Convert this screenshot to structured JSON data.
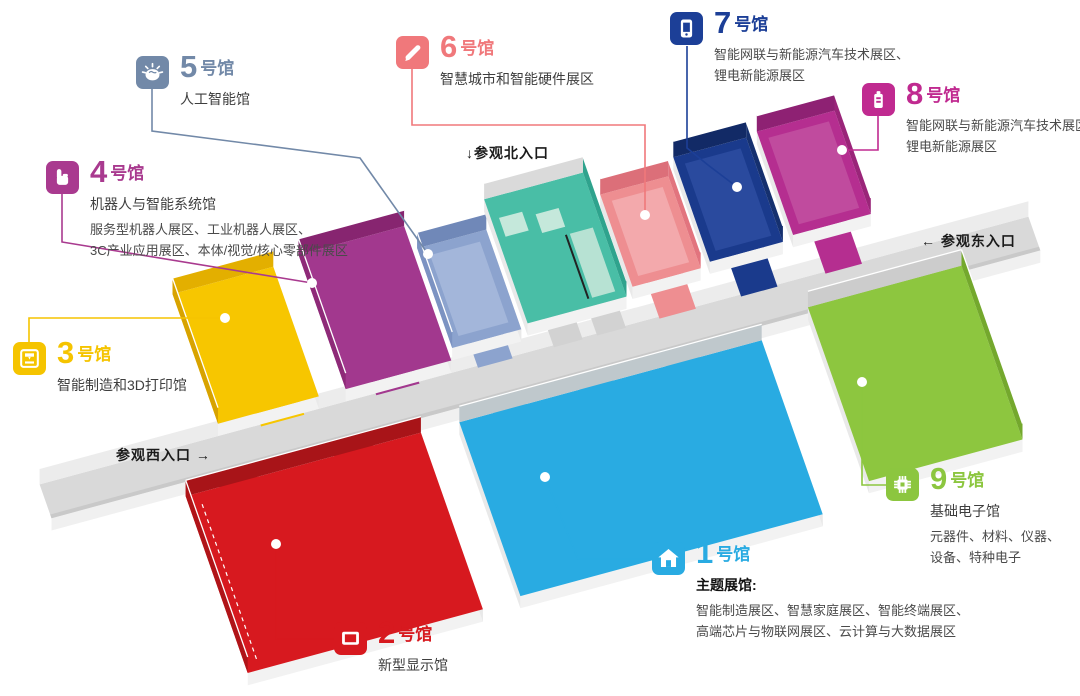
{
  "halls": [
    {
      "num": "1",
      "suffix": "号馆",
      "color": "#29ABE2",
      "subtitle": "主题展馆:",
      "subtitle_bold": true,
      "desc": [
        "智能制造展区、智慧家庭展区、智能终端展区、",
        "高端芯片与物联网展区、云计算与大数据展区"
      ],
      "icon": "house-icon"
    },
    {
      "num": "2",
      "suffix": "号馆",
      "color": "#D7191F",
      "subtitle": "新型显示馆",
      "desc": [],
      "icon": "display-icon"
    },
    {
      "num": "3",
      "suffix": "号馆",
      "color": "#F5C400",
      "subtitle": "智能制造和3D打印馆",
      "desc": [],
      "icon": "printer-3d-icon"
    },
    {
      "num": "4",
      "suffix": "号馆",
      "color": "#A93A8F",
      "subtitle": "机器人与智能系统馆",
      "desc": [
        "服务型机器人展区、工业机器人展区、",
        "3C产业应用展区、本体/视觉/核心零部件展区"
      ],
      "icon": "hand-icon"
    },
    {
      "num": "5",
      "suffix": "号馆",
      "color": "#7289A8",
      "subtitle": "人工智能馆",
      "desc": [],
      "icon": "brain-icon"
    },
    {
      "num": "6",
      "suffix": "号馆",
      "color": "#F0787B",
      "subtitle": "智慧城市和智能硬件展区",
      "desc": [],
      "icon": "pen-icon"
    },
    {
      "num": "7",
      "suffix": "号馆",
      "color": "#1C3F97",
      "subtitle": "",
      "desc": [
        "智能网联与新能源汽车技术展区、",
        "锂电新能源展区"
      ],
      "icon": "smart-device-icon"
    },
    {
      "num": "8",
      "suffix": "号馆",
      "color": "#C02A90",
      "subtitle": "",
      "desc": [
        "智能网联与新能源汽车技术展区",
        "锂电新能源展区"
      ],
      "icon": "battery-icon"
    },
    {
      "num": "9",
      "suffix": "号馆",
      "color": "#8CC63F",
      "subtitle": "基础电子馆",
      "desc": [
        "元器件、材料、仪器、",
        "设备、特种电子"
      ],
      "icon": "chip-icon"
    }
  ],
  "entrances": {
    "north": "↓参观北入口",
    "east": "← 参观东入口",
    "west": "参观西入口 →"
  },
  "floorplan": {
    "matrix": [
      0.96,
      -0.26,
      0.33,
      0.94,
      30,
      487
    ],
    "up": [
      5.34,
      -15.54
    ],
    "dn": [
      -4.08,
      11.9
    ],
    "corridor": {
      "u0": 10,
      "u1": 1040,
      "v0": 0,
      "v1": 36,
      "floor": "#D9D9D9",
      "n_wall": "#ECECEC",
      "s_wall": "#F0F0F0",
      "s_shadow": "#C9C9C9"
    },
    "halls": [
      {
        "name": "hall-3",
        "floor": "#F7C600",
        "u0": 200,
        "u1": 305,
        "vB": -150,
        "vF": -12,
        "inner": [
          [
            "N",
            "#E3AF00"
          ],
          [
            "W",
            "#D8A300"
          ]
        ],
        "outer": [
          "S",
          "E"
        ]
      },
      {
        "name": "hall-4",
        "floor": "#A2388E",
        "u0": 333,
        "u1": 443,
        "vB": -155,
        "vF": -12,
        "inner": [
          [
            "N",
            "#872570"
          ],
          [
            "W",
            "#8E2A78"
          ]
        ],
        "outer": [
          "S",
          "E"
        ]
      },
      {
        "name": "hall-5",
        "floor": "#8CA3CE",
        "u0": 448,
        "u1": 520,
        "vB": -130,
        "vF": -24,
        "inner": [
          [
            "N",
            "#7088B8"
          ],
          [
            "W",
            "#7C93C2"
          ]
        ],
        "outer": [
          "S",
          "E"
        ],
        "inset": {
          "pad": 10,
          "fill": "#A3B6DA"
        }
      },
      {
        "name": "north-entrance-hall",
        "floor": "#49BEA6",
        "u0": 528,
        "u1": 631,
        "vB": -160,
        "vF": -28,
        "inner": [
          [
            "N",
            "#DADADA"
          ],
          [
            "E",
            "#2FA38D"
          ]
        ],
        "outer": [
          "S",
          "W"
        ],
        "extras": [
          {
            "u0": 536,
            "u1": 560,
            "v0": -138,
            "v1": -118,
            "fill": "#C5E8DB"
          },
          {
            "u0": 572,
            "u1": 596,
            "v0": -132,
            "v1": -112,
            "fill": "#C5E8DB"
          },
          {
            "u0": 598,
            "u1": 622,
            "v0": -104,
            "v1": -36,
            "fill": "#B7E2D3"
          },
          {
            "line": [
              [
                594,
                -104
              ],
              [
                594,
                -36
              ]
            ],
            "stroke": "#222222",
            "w": 2
          }
        ]
      },
      {
        "name": "hall-6",
        "floor": "#EE8E91",
        "u0": 640,
        "u1": 711,
        "vB": -134,
        "vF": -36,
        "inner": [
          [
            "N",
            "#DC6F79"
          ],
          [
            "E",
            "#E2747E"
          ]
        ],
        "outer": [
          "S",
          "W"
        ],
        "inset": {
          "pad": 9,
          "fill": "#F3A9AC"
        }
      },
      {
        "name": "hall-7",
        "floor": "#1A3A8C",
        "u0": 722,
        "u1": 798,
        "vB": -151,
        "vF": -40,
        "inner": [
          [
            "N",
            "#122A66"
          ],
          [
            "E",
            "#15306F"
          ]
        ],
        "outer": [
          "S",
          "W"
        ],
        "inset": {
          "pad": 9,
          "fill": "#2A4A9E"
        }
      },
      {
        "name": "hall-8",
        "floor": "#B52E90",
        "u0": 810,
        "u1": 891,
        "vB": -154,
        "vF": -44,
        "inner": [
          [
            "N",
            "#8E2173"
          ],
          [
            "E",
            "#9A2579"
          ]
        ],
        "outer": [
          "S",
          "W"
        ],
        "inset": {
          "pad": 9,
          "fill": "#C04B9E"
        }
      },
      {
        "name": "hall-2",
        "floor": "#D7191F",
        "u0": 145,
        "u1": 390,
        "vB": 50,
        "vF": 238,
        "inner": [
          [
            "N",
            "#A81418"
          ],
          [
            "W",
            "#B01418"
          ]
        ],
        "outer": [
          "S",
          "E"
        ],
        "dash": [
          [
            158,
            62
          ],
          [
            158,
            228
          ]
        ]
      },
      {
        "name": "hall-1",
        "floor": "#29ABE2",
        "u0": 430,
        "u1": 745,
        "vB": 50,
        "vF": 235,
        "inner": [
          [
            "N",
            "#BFC8CC"
          ]
        ],
        "outer": [
          "S",
          "E",
          "W"
        ]
      },
      {
        "name": "hall-9",
        "floor": "#8DC63F",
        "u0": 800,
        "u1": 960,
        "vB": 30,
        "vF": 215,
        "inner": [
          [
            "N",
            "#CCCCCC"
          ],
          [
            "E",
            "#74A82D"
          ]
        ],
        "outer": [
          "S",
          "W"
        ]
      }
    ],
    "stubs": [
      {
        "u0": 240,
        "u1": 285,
        "v0": -14,
        "v1": 2,
        "fill": "#F7C600"
      },
      {
        "u0": 360,
        "u1": 405,
        "v0": -14,
        "v1": 2,
        "fill": "#A2388E"
      },
      {
        "u0": 466,
        "u1": 502,
        "v0": -26,
        "v1": 2,
        "fill": "#8CA3CE"
      },
      {
        "u0": 545,
        "u1": 575,
        "v0": -30,
        "v1": 2,
        "fill": "#D2D2D2"
      },
      {
        "u0": 590,
        "u1": 620,
        "v0": -30,
        "v1": 2,
        "fill": "#D2D2D2"
      },
      {
        "u0": 655,
        "u1": 693,
        "v0": -38,
        "v1": 2,
        "fill": "#EE8E91"
      },
      {
        "u0": 740,
        "u1": 778,
        "v0": -42,
        "v1": 2,
        "fill": "#1A3A8C"
      },
      {
        "u0": 828,
        "u1": 866,
        "v0": -46,
        "v1": 2,
        "fill": "#B52E90"
      },
      {
        "u0": 180,
        "u1": 220,
        "v0": 34,
        "v1": 52,
        "fill": "#D7191F"
      },
      {
        "u0": 300,
        "u1": 340,
        "v0": 34,
        "v1": 52,
        "fill": "#D7191F"
      },
      {
        "u0": 465,
        "u1": 500,
        "v0": 34,
        "v1": 52,
        "fill": "#29ABE2"
      },
      {
        "u0": 555,
        "u1": 590,
        "v0": 34,
        "v1": 52,
        "fill": "#29ABE2"
      },
      {
        "u0": 645,
        "u1": 680,
        "v0": 34,
        "v1": 52,
        "fill": "#29ABE2"
      },
      {
        "u0": 845,
        "u1": 885,
        "v0": 20,
        "v1": 32,
        "fill": "#D0D0D0"
      }
    ],
    "leaders": [
      {
        "name": "hall-3",
        "color": "#F5C400",
        "points": [
          [
            29,
            342
          ],
          [
            29,
            318
          ],
          [
            225,
            318
          ]
        ],
        "dot": [
          225,
          318
        ]
      },
      {
        "name": "hall-4",
        "color": "#A93A8F",
        "points": [
          [
            62,
            193
          ],
          [
            62,
            242
          ],
          [
            312,
            283
          ]
        ],
        "dot": [
          312,
          283
        ]
      },
      {
        "name": "hall-5",
        "color": "#7289A8",
        "points": [
          [
            152,
            89
          ],
          [
            152,
            131
          ],
          [
            360,
            158
          ],
          [
            428,
            254
          ]
        ],
        "dot": [
          428,
          254
        ]
      },
      {
        "name": "hall-6",
        "color": "#F0787B",
        "points": [
          [
            412,
            69
          ],
          [
            412,
            125
          ],
          [
            645,
            125
          ],
          [
            645,
            215
          ]
        ],
        "dot": [
          645,
          215
        ]
      },
      {
        "name": "hall-7",
        "color": "#1C3F97",
        "points": [
          [
            687,
            46
          ],
          [
            687,
            148
          ],
          [
            708,
            165
          ],
          [
            737,
            187
          ]
        ],
        "dot": [
          737,
          187
        ]
      },
      {
        "name": "hall-8",
        "color": "#C02A90",
        "points": [
          [
            878,
            115
          ],
          [
            878,
            150
          ],
          [
            842,
            150
          ]
        ],
        "dot": [
          842,
          150
        ]
      },
      {
        "name": "hall-2",
        "color": "#D7191F",
        "points": [
          [
            334,
            639
          ],
          [
            276,
            639
          ],
          [
            276,
            544
          ]
        ],
        "dot": [
          276,
          544
        ]
      },
      {
        "name": "hall-1",
        "color": "#29ABE2",
        "points": [
          [
            652,
            559
          ],
          [
            578,
            559
          ],
          [
            545,
            477
          ]
        ],
        "dot": [
          545,
          477
        ]
      },
      {
        "name": "hall-9",
        "color": "#8CC63F",
        "points": [
          [
            886,
            485
          ],
          [
            862,
            485
          ],
          [
            862,
            382
          ]
        ],
        "dot": [
          862,
          382
        ]
      }
    ]
  }
}
